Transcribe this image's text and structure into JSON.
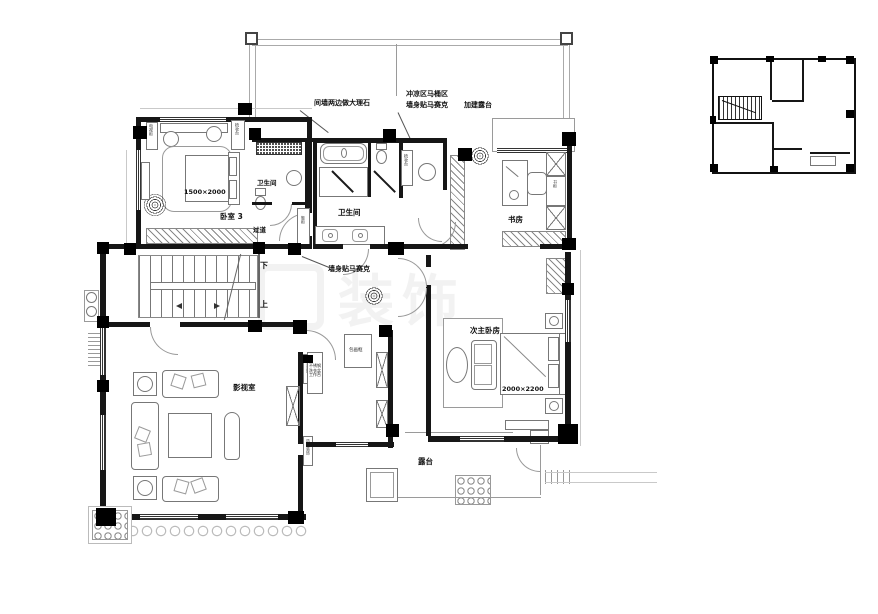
{
  "plan": {
    "rooms": [
      {
        "id": "bedroom-3",
        "label": "卧室 3"
      },
      {
        "id": "bathroom-1",
        "label": "卫生间"
      },
      {
        "id": "corridor",
        "label": "过道"
      },
      {
        "id": "bathroom-2",
        "label": "卫生间"
      },
      {
        "id": "study",
        "label": "书房"
      },
      {
        "id": "media-room",
        "label": "影视室"
      },
      {
        "id": "second-master-bedroom",
        "label": "次主卧房"
      },
      {
        "id": "terrace",
        "label": "露台"
      }
    ],
    "dimensions": [
      {
        "id": "bedroom3-bed-size",
        "label": "1500×2000"
      },
      {
        "id": "second-master-bed-size",
        "label": "2000×2200"
      }
    ],
    "annotations": [
      {
        "id": "marble-note",
        "label": "间墙两边做大理石"
      },
      {
        "id": "shower-zone-note-line1",
        "label": "冲凉区马桶区"
      },
      {
        "id": "shower-zone-note-line2",
        "label": "墙身贴马赛克"
      },
      {
        "id": "added-terrace-note",
        "label": "加建露台"
      },
      {
        "id": "wall-mosaic-note",
        "label": "墙身贴马赛克"
      }
    ],
    "stairs": {
      "down": "下",
      "up": "上"
    },
    "fixtures": [
      {
        "id": "tv-cabinet",
        "label": "电视柜"
      },
      {
        "id": "bedroom3-dresser",
        "label": "梳妆台"
      },
      {
        "id": "shoe-cabinet",
        "label": "鞋柜"
      },
      {
        "id": "powder-dresser",
        "label": "梳妆台"
      },
      {
        "id": "bookcase",
        "label": "书柜"
      },
      {
        "id": "frame-cabinet",
        "label": "包画框"
      },
      {
        "id": "feature-wall-a",
        "label": "造型装饰"
      },
      {
        "id": "feature-wall-b",
        "label": "造型装饰"
      },
      {
        "id": "worktable-note",
        "label": "不锈钢洗衣盆工作台"
      }
    ],
    "watermark": "装饰"
  }
}
